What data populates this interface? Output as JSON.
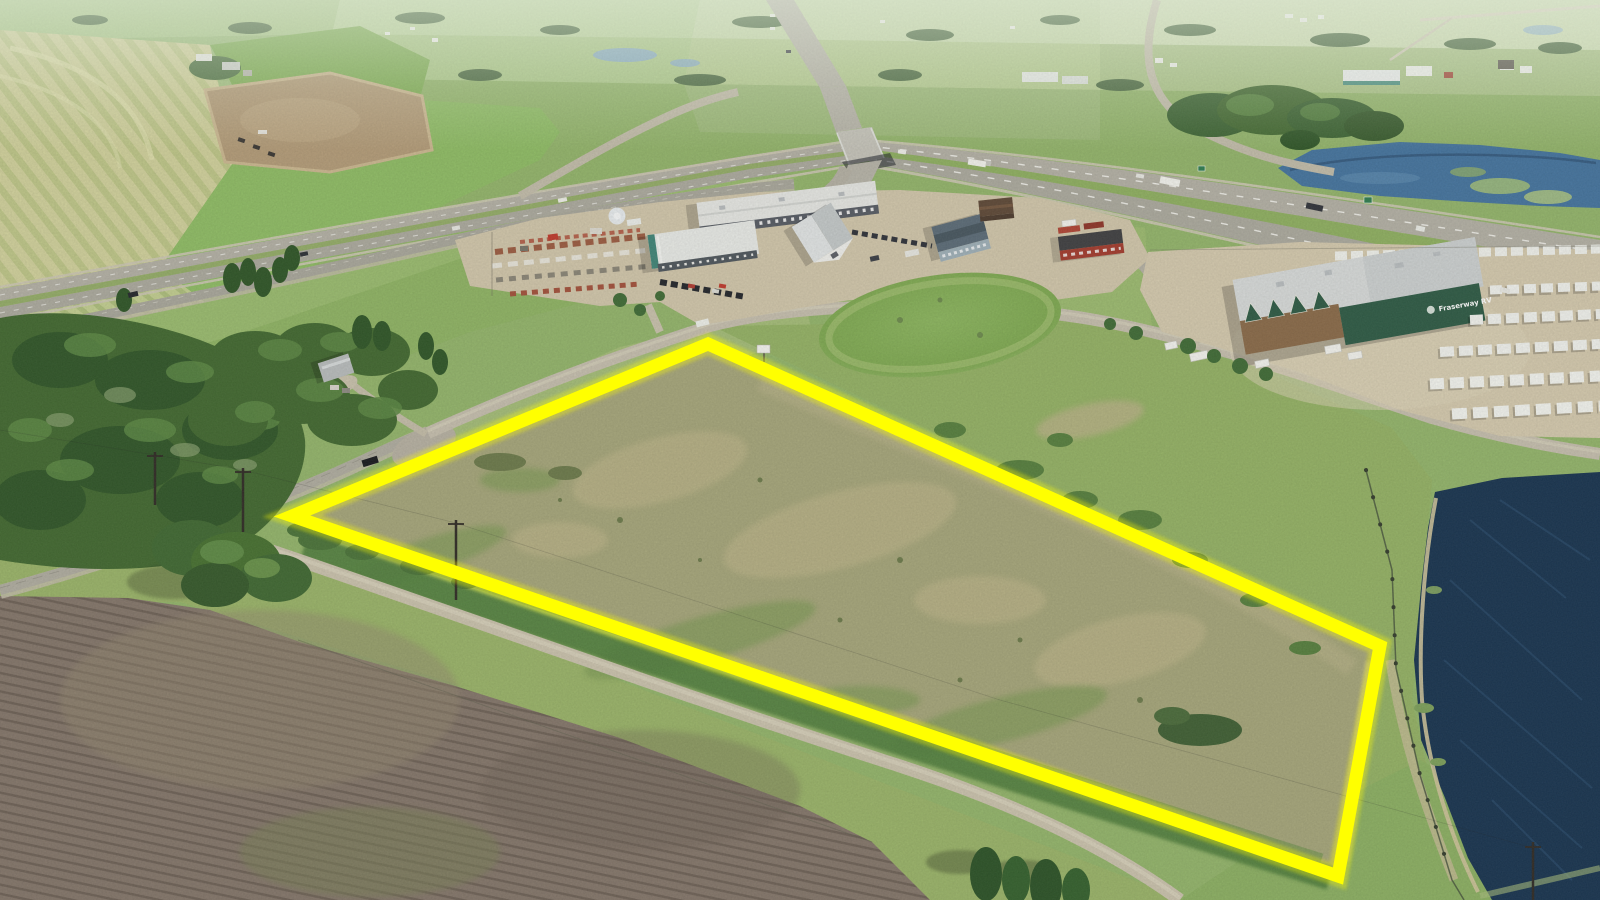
{
  "meta": {
    "media": "aerial-drone-photograph",
    "subject": "vacant land parcel outlined in yellow beside highway interchange and commercial area",
    "canvas": {
      "width": 1600,
      "height": 900
    }
  },
  "annotation": {
    "parcel_outline": {
      "shape": "quadrilateral",
      "points": "292,516 708,344 1380,646 1338,876",
      "color": "#ffff00",
      "stroke_width": "13",
      "glow_width": "21"
    }
  },
  "labels": {
    "rv_dealership_logo": "Fraserway RV"
  },
  "scene": {
    "palette": {
      "field_green": "#8fbd64",
      "pale_grass": "#a4bd77",
      "parcel_scrub": "#a6a67a",
      "plowed_brown": "#84766a",
      "pond_navy": "#17334f",
      "distant_pond_blue": "#44749f",
      "road_paved": "#aeaba0",
      "road_gravel": "#c9c1ab",
      "tree_dark": "#3f6b35",
      "commercial_tan": "#d2c7ab",
      "horizon_haze": "#cfe0c2",
      "dealership_green": "#2d5a44"
    },
    "features": [
      "divided-highway",
      "overpass-bridge",
      "frontage-road",
      "commercial-yards",
      "rv-dealership",
      "equipment-yard",
      "grass-knoll",
      "treed-acreage",
      "plowed-field",
      "gravel-road",
      "storm-pond",
      "distant-town",
      "subject-parcel-outline"
    ]
  }
}
